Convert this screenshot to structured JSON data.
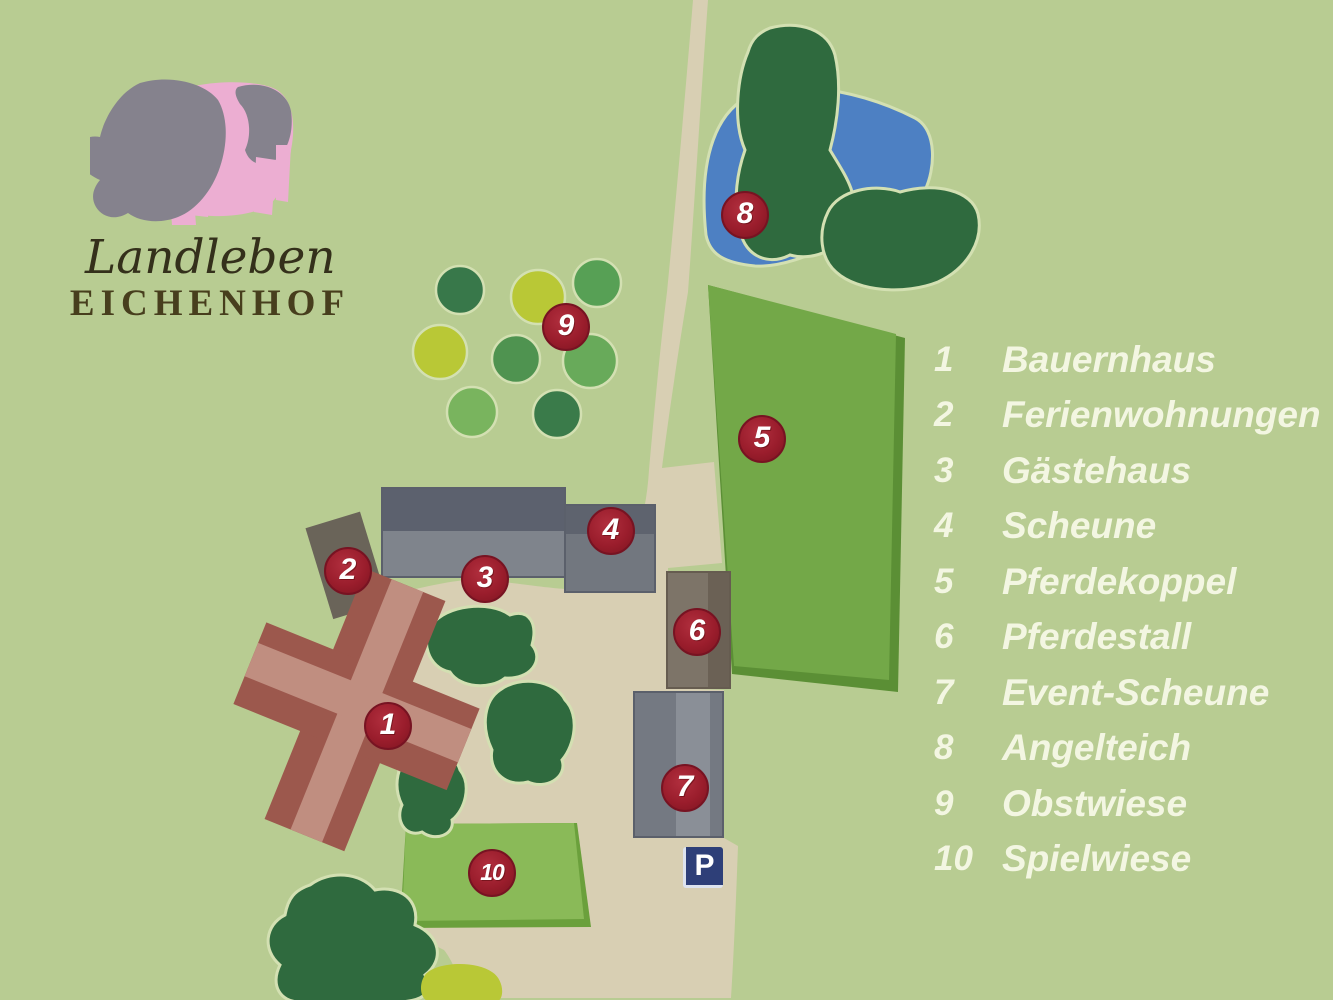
{
  "logo": {
    "script_line": "Landleben",
    "caps_line": "EICHENHOF",
    "pig_icon_colors": {
      "pink": "#ecaed2",
      "gray": "#85828d"
    }
  },
  "legend": {
    "items": [
      {
        "num": "1",
        "label": "Bauernhaus"
      },
      {
        "num": "2",
        "label": "Ferienwohnungen"
      },
      {
        "num": "3",
        "label": "Gästehaus"
      },
      {
        "num": "4",
        "label": "Scheune"
      },
      {
        "num": "5",
        "label": "Pferdekoppel"
      },
      {
        "num": "6",
        "label": "Pferdestall"
      },
      {
        "num": "7",
        "label": "Event-Scheune"
      },
      {
        "num": "8",
        "label": "Angelteich"
      },
      {
        "num": "9",
        "label": "Obstwiese"
      },
      {
        "num": "10",
        "label": "Spielwiese"
      }
    ],
    "text_color": "#f3f6e2"
  },
  "map": {
    "parking_label": "P",
    "markers": [
      {
        "num": "1"
      },
      {
        "num": "2"
      },
      {
        "num": "3"
      },
      {
        "num": "4"
      },
      {
        "num": "5"
      },
      {
        "num": "6"
      },
      {
        "num": "7"
      },
      {
        "num": "8"
      },
      {
        "num": "9"
      },
      {
        "num": "10"
      }
    ],
    "colors": {
      "background": "#b8cc92",
      "path_and_yard": "#d8cfb3",
      "pond_blue": "#4d80c3",
      "tree_dark_green": "#2f6a3e",
      "paddock_green": "#73a848",
      "paddock_edge": "#5b8f35",
      "meadow_green": "#8aba58",
      "meadow_edge": "#6ba03c",
      "building_gray": "#7f848c",
      "roof_dark_gray": "#5c616e",
      "farmhouse_red": "#9c584d",
      "farmhouse_ridge": "#c08e80",
      "marker_red": "#9a1d2c",
      "parking_blue": "#2e3f78"
    }
  }
}
